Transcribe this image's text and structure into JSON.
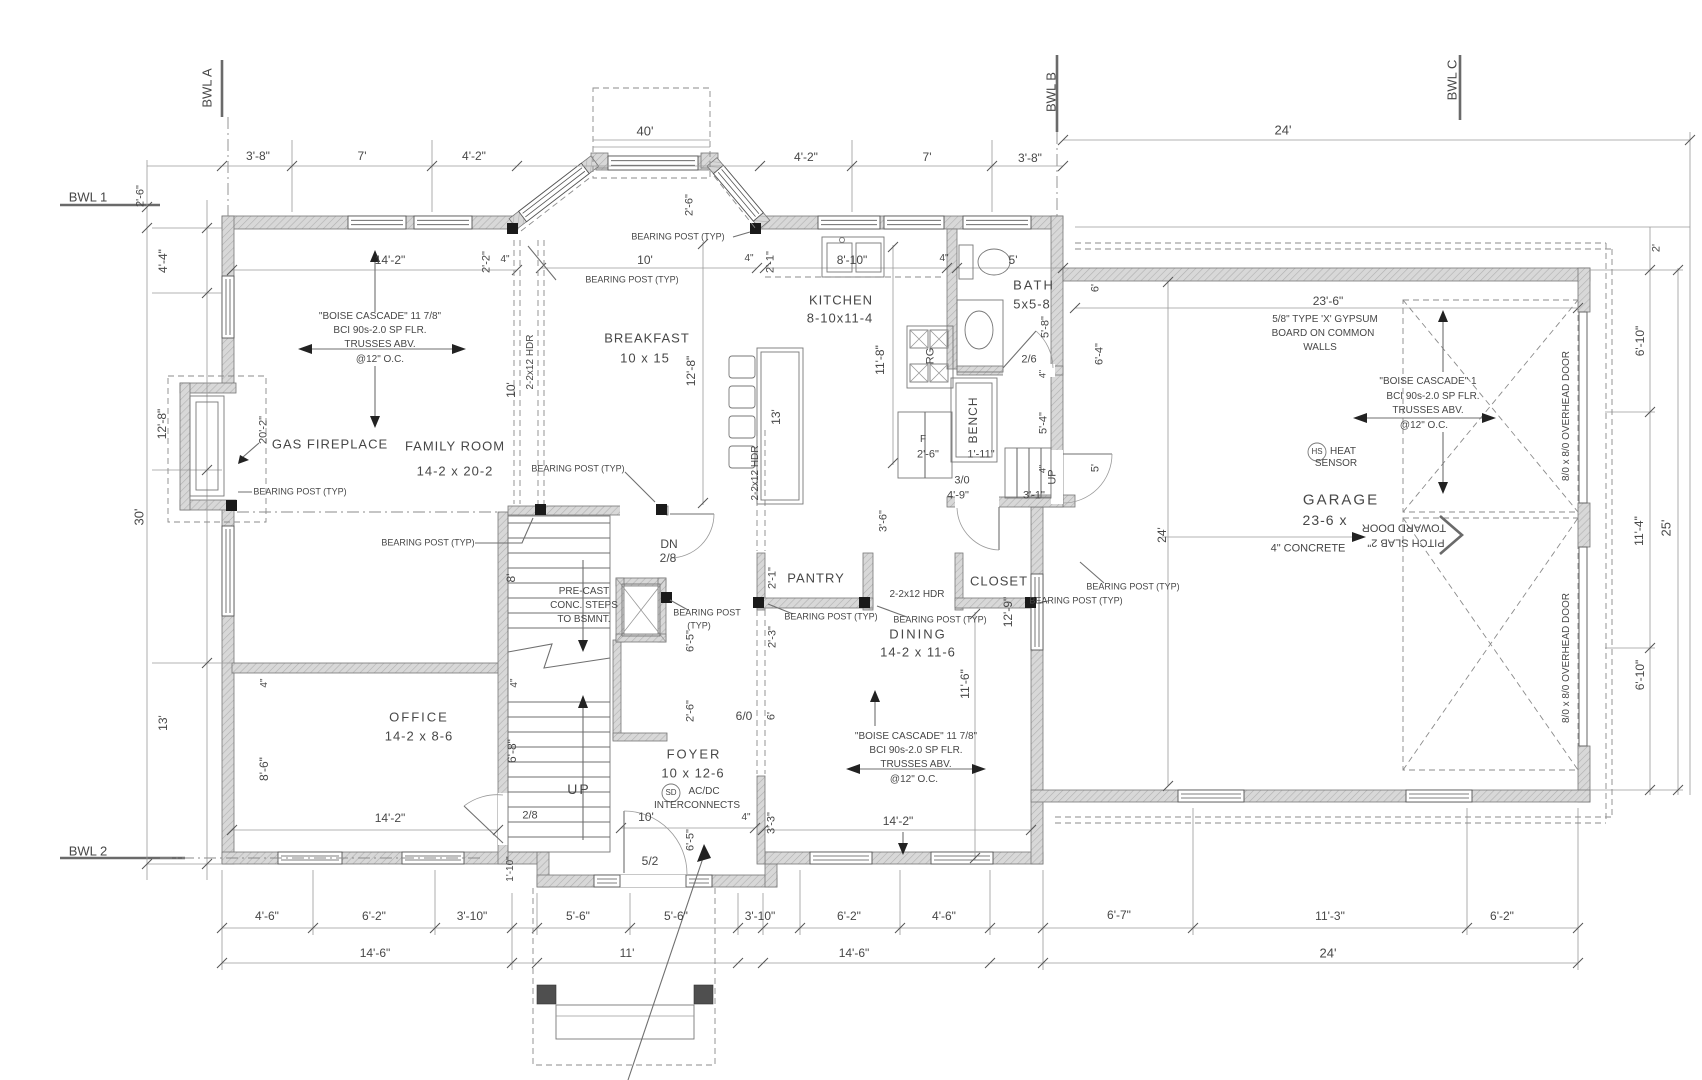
{
  "colors": {
    "wall_fill": "#d8d8d8",
    "hatch_line": "#b0b0b0",
    "line": "#8b8b8b",
    "text": "#474747"
  },
  "labels": [
    {
      "n": "grid-bwl-a",
      "t": "BWL A",
      "x": 207,
      "y": 88,
      "r": -90,
      "fs": 13
    },
    {
      "n": "grid-bwl-b",
      "t": "BWL B",
      "x": 1051,
      "y": 92,
      "r": -90,
      "fs": 13
    },
    {
      "n": "grid-bwl-c",
      "t": "BWL C",
      "x": 1452,
      "y": 80,
      "r": -90,
      "fs": 13
    },
    {
      "n": "grid-bwl-1",
      "t": "BWL 1",
      "x": 88,
      "y": 197,
      "fs": 13
    },
    {
      "n": "grid-bwl-2",
      "t": "BWL 2",
      "x": 88,
      "y": 851,
      "fs": 13
    },
    {
      "t": "3'-8\"",
      "x": 258,
      "y": 156
    },
    {
      "t": "7'",
      "x": 362,
      "y": 156
    },
    {
      "t": "4'-2\"",
      "x": 474,
      "y": 156
    },
    {
      "t": "40'",
      "x": 645,
      "y": 131,
      "fs": 13
    },
    {
      "t": "4'-2\"",
      "x": 806,
      "y": 157
    },
    {
      "t": "7'",
      "x": 927,
      "y": 157
    },
    {
      "t": "3'-8\"",
      "x": 1030,
      "y": 158
    },
    {
      "t": "24'",
      "x": 1283,
      "y": 130,
      "fs": 13
    },
    {
      "t": "2'-6\"",
      "x": 141,
      "y": 196,
      "r": -90,
      "fs": 11
    },
    {
      "t": "2'-6\"",
      "x": 690,
      "y": 205,
      "r": -90,
      "fs": 11
    },
    {
      "t": "2'",
      "x": 1657,
      "y": 248,
      "r": -90,
      "fs": 11
    },
    {
      "t": "14'-2\"",
      "x": 390,
      "y": 260
    },
    {
      "t": "2'-2\"",
      "x": 487,
      "y": 262,
      "r": -90,
      "fs": 11
    },
    {
      "t": "4\"",
      "x": 505,
      "y": 260,
      "fs": 10
    },
    {
      "t": "10'",
      "x": 645,
      "y": 260
    },
    {
      "t": "4\"",
      "x": 749,
      "y": 259,
      "fs": 10
    },
    {
      "t": "2'-1\"",
      "x": 771,
      "y": 262,
      "r": -90,
      "fs": 11
    },
    {
      "t": "8'-10\"",
      "x": 852,
      "y": 260
    },
    {
      "t": "4\"",
      "x": 944,
      "y": 259,
      "fs": 10
    },
    {
      "t": "5'",
      "x": 1013,
      "y": 260
    },
    {
      "t": "23'-6\"",
      "x": 1328,
      "y": 301
    },
    {
      "t": "4'-4\"",
      "x": 163,
      "y": 261,
      "r": -90
    },
    {
      "t": "12'-8\"",
      "x": 162,
      "y": 424,
      "r": -90
    },
    {
      "t": "30'",
      "x": 139,
      "y": 517,
      "r": -90,
      "fs": 13
    },
    {
      "t": "13'",
      "x": 163,
      "y": 723,
      "r": -90
    },
    {
      "t": "20'-2\"",
      "x": 264,
      "y": 430,
      "r": -90,
      "fs": 11
    },
    {
      "n": "note-family-joists-1",
      "t": "\"BOISE CASCADE\" 11 7/8\"",
      "x": 380,
      "y": 317,
      "fs": 10
    },
    {
      "t": "BCI 90s-2.0 SP FLR.",
      "x": 380,
      "y": 331,
      "fs": 10
    },
    {
      "t": "TRUSSES ABV.",
      "x": 380,
      "y": 345,
      "fs": 10
    },
    {
      "t": "@12\" O.C.",
      "x": 380,
      "y": 360,
      "fs": 10
    },
    {
      "n": "room-gas-fireplace",
      "t": "GAS FIREPLACE",
      "x": 330,
      "y": 444,
      "fs": 13,
      "ls": 1
    },
    {
      "n": "room-family",
      "t": "FAMILY ROOM",
      "x": 455,
      "y": 446,
      "fs": 13,
      "ls": 1
    },
    {
      "t": "14-2 x 20-2",
      "x": 455,
      "y": 471,
      "fs": 13,
      "ls": 1
    },
    {
      "t": "2-2x12 HDR",
      "x": 531,
      "y": 362,
      "r": -90,
      "fs": 10
    },
    {
      "t": "10'",
      "x": 511,
      "y": 390,
      "r": -90
    },
    {
      "t": "BEARING POST (TYP)",
      "x": 632,
      "y": 280,
      "fs": 9
    },
    {
      "t": "BEARING POST (TYP)",
      "x": 678,
      "y": 237,
      "fs": 9
    },
    {
      "t": "BEARING POST (TYP)",
      "x": 300,
      "y": 492,
      "fs": 9
    },
    {
      "t": "BEARING POST (TYP)",
      "x": 428,
      "y": 543,
      "fs": 9
    },
    {
      "t": "BEARING POST (TYP)",
      "x": 578,
      "y": 469,
      "fs": 9
    },
    {
      "t": "BEARING POST",
      "x": 707,
      "y": 613,
      "fs": 9
    },
    {
      "t": "(TYP)",
      "x": 699,
      "y": 626,
      "fs": 9
    },
    {
      "t": "BEARING POST (TYP)",
      "x": 831,
      "y": 617,
      "fs": 9
    },
    {
      "t": "BEARING POST (TYP)",
      "x": 940,
      "y": 620,
      "fs": 9
    },
    {
      "t": "BEARING POST (TYP)",
      "x": 1076,
      "y": 601,
      "fs": 9
    },
    {
      "t": "BEARING POST (TYP)",
      "x": 1133,
      "y": 587,
      "fs": 9
    },
    {
      "n": "room-breakfast",
      "t": "BREAKFAST",
      "x": 647,
      "y": 338,
      "fs": 13,
      "ls": 1
    },
    {
      "t": "10 x 15",
      "x": 645,
      "y": 358,
      "fs": 13,
      "ls": 1
    },
    {
      "t": "12'-8\"",
      "x": 691,
      "y": 371,
      "r": -90
    },
    {
      "t": "13'",
      "x": 776,
      "y": 417,
      "r": -90
    },
    {
      "n": "room-kitchen",
      "t": "KITCHEN",
      "x": 841,
      "y": 300,
      "fs": 13,
      "ls": 1
    },
    {
      "t": "8-10x11-4",
      "x": 840,
      "y": 318,
      "fs": 13,
      "ls": 1
    },
    {
      "t": "11'-8\"",
      "x": 880,
      "y": 360,
      "r": -90
    },
    {
      "t": "2-2x12 HDR",
      "x": 756,
      "y": 473,
      "r": -90,
      "fs": 10
    },
    {
      "t": "RG",
      "x": 931,
      "y": 356,
      "r": -90,
      "fs": 11
    },
    {
      "t": "F",
      "x": 923,
      "y": 440,
      "fs": 10
    },
    {
      "t": "2'-6\"",
      "x": 928,
      "y": 455,
      "fs": 11
    },
    {
      "t": "1'-11\"",
      "x": 981,
      "y": 455,
      "fs": 11
    },
    {
      "n": "fixture-bench",
      "t": "BENCH",
      "x": 973,
      "y": 420,
      "r": -90,
      "fs": 12,
      "ls": 1
    },
    {
      "t": "4'-9\"",
      "x": 958,
      "y": 496,
      "fs": 11
    },
    {
      "t": "3'-1\"",
      "x": 1034,
      "y": 496,
      "fs": 11
    },
    {
      "t": "3/0",
      "x": 962,
      "y": 481,
      "fs": 11
    },
    {
      "n": "room-bath",
      "t": "BATH",
      "x": 1034,
      "y": 285,
      "fs": 13,
      "ls": 2
    },
    {
      "t": "5x5-8",
      "x": 1032,
      "y": 304,
      "fs": 13,
      "ls": 1
    },
    {
      "t": "5'-8\"",
      "x": 1046,
      "y": 327,
      "r": -90,
      "fs": 11
    },
    {
      "t": "2/6",
      "x": 1029,
      "y": 360,
      "fs": 11
    },
    {
      "t": "5'-4\"",
      "x": 1044,
      "y": 423,
      "r": -90,
      "fs": 11
    },
    {
      "t": "4\"",
      "x": 1043,
      "y": 374,
      "r": -90,
      "fs": 9
    },
    {
      "t": "4\"",
      "x": 1043,
      "y": 469,
      "r": -90,
      "fs": 9
    },
    {
      "t": "6'",
      "x": 1096,
      "y": 288,
      "r": -90,
      "fs": 11
    },
    {
      "t": "6'-4\"",
      "x": 1100,
      "y": 354,
      "r": -90,
      "fs": 11
    },
    {
      "t": "5'",
      "x": 1096,
      "y": 468,
      "r": -90,
      "fs": 11
    },
    {
      "t": "24'",
      "x": 1162,
      "y": 535,
      "r": -90
    },
    {
      "t": "UP",
      "x": 1053,
      "y": 477,
      "r": -90,
      "fs": 11
    },
    {
      "t": "12'-9\"",
      "x": 1008,
      "y": 612,
      "r": -90
    },
    {
      "t": "11'-6\"",
      "x": 965,
      "y": 684,
      "r": -90
    },
    {
      "n": "room-pantry",
      "t": "PANTRY",
      "x": 816,
      "y": 578,
      "fs": 13,
      "ls": 1
    },
    {
      "n": "room-closet",
      "t": "CLOSET",
      "x": 999,
      "y": 581,
      "fs": 13,
      "ls": 1
    },
    {
      "t": "2-2x12 HDR",
      "x": 917,
      "y": 595,
      "fs": 10
    },
    {
      "n": "room-dining",
      "t": "DINING",
      "x": 918,
      "y": 634,
      "fs": 13,
      "ls": 2
    },
    {
      "t": "14-2 x 11-6",
      "x": 918,
      "y": 652,
      "fs": 13,
      "ls": 1
    },
    {
      "t": "2'-1\"",
      "x": 773,
      "y": 578,
      "r": -90,
      "fs": 11
    },
    {
      "t": "2'-3\"",
      "x": 773,
      "y": 637,
      "r": -90,
      "fs": 11
    },
    {
      "t": "3'-6\"",
      "x": 884,
      "y": 521,
      "r": -90,
      "fs": 11
    },
    {
      "t": "6/0",
      "x": 744,
      "y": 716
    },
    {
      "t": "6'",
      "x": 772,
      "y": 716,
      "r": -90,
      "fs": 11
    },
    {
      "n": "note-dining-joists-1",
      "t": "\"BOISE CASCADE\" 11 7/8\"",
      "x": 916,
      "y": 737,
      "fs": 10
    },
    {
      "t": "BCI 90s-2.0 SP FLR.",
      "x": 916,
      "y": 751,
      "fs": 10
    },
    {
      "t": "TRUSSES ABV.",
      "x": 916,
      "y": 765,
      "fs": 10
    },
    {
      "t": "@12\" O.C.",
      "x": 914,
      "y": 780,
      "fs": 10
    },
    {
      "t": "14'-2\"",
      "x": 898,
      "y": 821
    },
    {
      "t": "4\"",
      "x": 746,
      "y": 818,
      "fs": 10
    },
    {
      "t": "3'-3\"",
      "x": 772,
      "y": 823,
      "r": -90,
      "fs": 11
    },
    {
      "t": "DN",
      "x": 669,
      "y": 544
    },
    {
      "t": "2/8",
      "x": 668,
      "y": 558
    },
    {
      "t": "PRE-CAST",
      "x": 584,
      "y": 592,
      "fs": 10
    },
    {
      "t": "CONC. STEPS",
      "x": 584,
      "y": 606,
      "fs": 10
    },
    {
      "t": "TO BSMNT.",
      "x": 584,
      "y": 620,
      "fs": 10
    },
    {
      "t": "8'",
      "x": 511,
      "y": 578,
      "r": -90
    },
    {
      "t": "6'-8\"",
      "x": 512,
      "y": 751,
      "r": -90
    },
    {
      "t": "6'-5\"",
      "x": 691,
      "y": 641,
      "r": -90,
      "fs": 11
    },
    {
      "t": "2'-6\"",
      "x": 691,
      "y": 711,
      "r": -90,
      "fs": 11
    },
    {
      "t": "UP",
      "x": 579,
      "y": 789,
      "fs": 14,
      "ls": 2
    },
    {
      "n": "room-foyer",
      "t": "FOYER",
      "x": 694,
      "y": 754,
      "fs": 13,
      "ls": 2
    },
    {
      "t": "10 x 12-6",
      "x": 693,
      "y": 773,
      "fs": 13,
      "ls": 1
    },
    {
      "t": "SD",
      "x": 671,
      "y": 793,
      "fs": 8
    },
    {
      "t": "AC/DC",
      "x": 704,
      "y": 792,
      "fs": 10
    },
    {
      "t": "INTERCONNECTS",
      "x": 697,
      "y": 806,
      "fs": 10
    },
    {
      "t": "10'",
      "x": 646,
      "y": 817
    },
    {
      "t": "6'-5\"",
      "x": 691,
      "y": 840,
      "r": -90,
      "fs": 11
    },
    {
      "t": "5/2",
      "x": 650,
      "y": 861
    },
    {
      "t": "2/8",
      "x": 530,
      "y": 816,
      "fs": 11
    },
    {
      "t": "1'-10\"",
      "x": 511,
      "y": 869,
      "r": -90,
      "fs": 10
    },
    {
      "n": "room-office",
      "t": "OFFICE",
      "x": 419,
      "y": 717,
      "fs": 13,
      "ls": 2
    },
    {
      "t": "14-2 x 8-6",
      "x": 419,
      "y": 736,
      "fs": 13,
      "ls": 1
    },
    {
      "t": "4\"",
      "x": 265,
      "y": 683,
      "r": -90,
      "fs": 10
    },
    {
      "t": "4\"",
      "x": 515,
      "y": 683,
      "r": -90,
      "fs": 10
    },
    {
      "t": "8'-6\"",
      "x": 264,
      "y": 769,
      "r": -90
    },
    {
      "t": "14'-2\"",
      "x": 390,
      "y": 818
    },
    {
      "n": "note-gypsum-1",
      "t": "5/8\" TYPE 'X' GYPSUM",
      "x": 1325,
      "y": 320,
      "fs": 10
    },
    {
      "t": "BOARD ON COMMON",
      "x": 1323,
      "y": 334,
      "fs": 10
    },
    {
      "t": "WALLS",
      "x": 1320,
      "y": 348,
      "fs": 10
    },
    {
      "n": "note-garage-joists-1",
      "t": "\"BOISE CASCADE\" 1",
      "x": 1428,
      "y": 382,
      "fs": 10
    },
    {
      "t": "BCI 90s-2.0 SP FLR.",
      "x": 1433,
      "y": 397,
      "fs": 10
    },
    {
      "t": "TRUSSES ABV.",
      "x": 1428,
      "y": 411,
      "fs": 10
    },
    {
      "t": "@12\" O.C.",
      "x": 1424,
      "y": 426,
      "fs": 10
    },
    {
      "n": "tag-heat-sensor",
      "t": "HS",
      "x": 1317,
      "y": 452,
      "fs": 8
    },
    {
      "t": "HEAT",
      "x": 1343,
      "y": 452,
      "fs": 10
    },
    {
      "t": "SENSOR",
      "x": 1336,
      "y": 464,
      "fs": 10
    },
    {
      "n": "room-garage",
      "t": "GARAGE",
      "x": 1341,
      "y": 500,
      "fs": 15,
      "ls": 2
    },
    {
      "t": "23-6 x",
      "x": 1325,
      "y": 520,
      "fs": 14,
      "ls": 1
    },
    {
      "t": "TOWARD DOOR",
      "x": 1404,
      "y": 527,
      "r": 180,
      "fs": 11
    },
    {
      "t": "PITCH SLAB 2\"",
      "x": 1406,
      "y": 542,
      "r": 180,
      "fs": 11
    },
    {
      "t": "4\" CONCRETE",
      "x": 1308,
      "y": 549,
      "fs": 11
    },
    {
      "n": "tag-overhead-door-1",
      "t": "8/0 x 8/0 OVERHEAD DOOR",
      "x": 1567,
      "y": 416,
      "r": -90,
      "fs": 10
    },
    {
      "n": "tag-overhead-door-2",
      "t": "8/0 x 8/0 OVERHEAD DOOR",
      "x": 1567,
      "y": 658,
      "r": -90,
      "fs": 10
    },
    {
      "t": "6'-10\"",
      "x": 1640,
      "y": 341,
      "r": -90
    },
    {
      "t": "11'-4\"",
      "x": 1639,
      "y": 531,
      "r": -90
    },
    {
      "t": "25'",
      "x": 1666,
      "y": 528,
      "r": -90,
      "fs": 13
    },
    {
      "t": "6'-10\"",
      "x": 1640,
      "y": 675,
      "r": -90
    },
    {
      "t": "4'-6\"",
      "x": 267,
      "y": 916
    },
    {
      "t": "6'-2\"",
      "x": 374,
      "y": 916
    },
    {
      "t": "3'-10\"",
      "x": 472,
      "y": 916
    },
    {
      "t": "5'-6\"",
      "x": 578,
      "y": 916
    },
    {
      "t": "5'-6\"",
      "x": 676,
      "y": 916
    },
    {
      "t": "3'-10\"",
      "x": 760,
      "y": 916
    },
    {
      "t": "6'-2\"",
      "x": 849,
      "y": 916
    },
    {
      "t": "4'-6\"",
      "x": 944,
      "y": 916
    },
    {
      "t": "6'-7\"",
      "x": 1119,
      "y": 915
    },
    {
      "t": "11'-3\"",
      "x": 1330,
      "y": 916
    },
    {
      "t": "6'-2\"",
      "x": 1502,
      "y": 916
    },
    {
      "t": "14'-6\"",
      "x": 375,
      "y": 953
    },
    {
      "t": "11'",
      "x": 627,
      "y": 953
    },
    {
      "t": "14'-6\"",
      "x": 854,
      "y": 953
    },
    {
      "t": "24'",
      "x": 1328,
      "y": 953,
      "fs": 13
    }
  ]
}
